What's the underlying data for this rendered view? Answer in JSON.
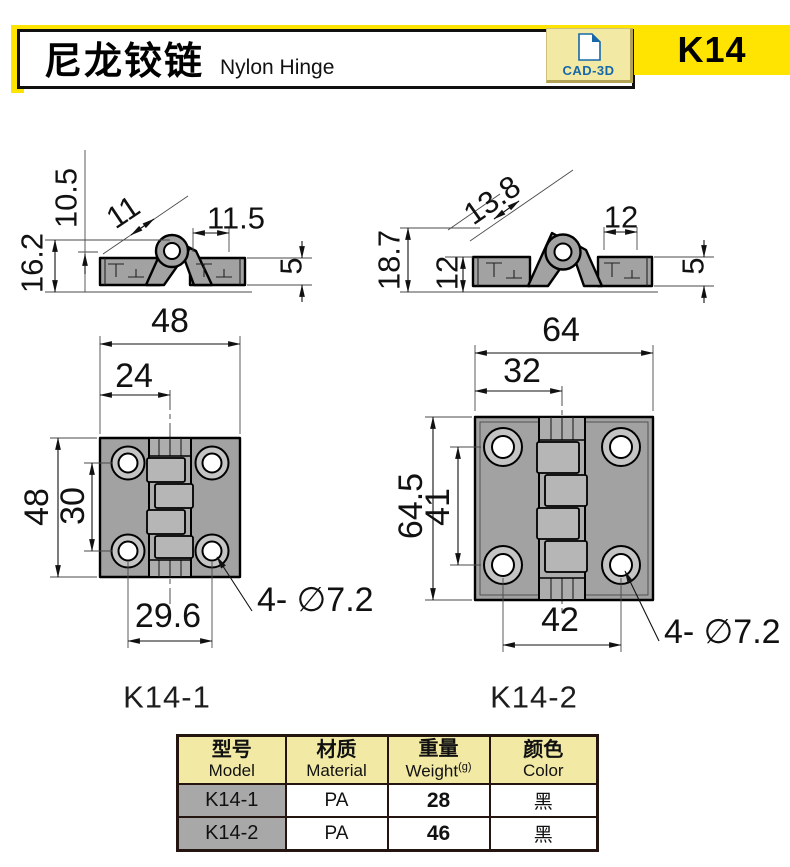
{
  "header": {
    "title_zh": "尼龙铰链",
    "title_en": "Nylon Hinge",
    "cad_badge": "CAD-3D",
    "product_code": "K14"
  },
  "colors": {
    "accent_yellow": "#FFE402",
    "pale_yellow": "#F2EAA4",
    "badge_blue": "#1668A8",
    "part_gray": "#A2A2A2",
    "table_border": "#241510"
  },
  "drawings": {
    "side_small": {
      "dim_height_outer": "16.2",
      "dim_height_inner": "10.5",
      "dim_knuckle": "11",
      "dim_leaf": "11.5",
      "dim_thickness": "5"
    },
    "side_large": {
      "dim_height_outer": "18.7",
      "dim_height_inner": "12",
      "dim_knuckle": "13.8",
      "dim_leaf": "12",
      "dim_thickness": "5"
    },
    "front_small": {
      "label": "K14-1",
      "dim_width": "48",
      "dim_half_width": "24",
      "dim_height": "48",
      "dim_hole_spacing_v": "30",
      "dim_hole_spacing_h": "29.6",
      "dim_holes": "4- ∅7.2"
    },
    "front_large": {
      "label": "K14-2",
      "dim_width": "64",
      "dim_half_width": "32",
      "dim_height": "64.5",
      "dim_hole_spacing_v": "41",
      "dim_hole_spacing_h": "42",
      "dim_holes": "4- ∅7.2"
    }
  },
  "spec_table": {
    "headers": [
      {
        "zh": "型号",
        "en": "Model"
      },
      {
        "zh": "材质",
        "en": "Material"
      },
      {
        "zh": "重量",
        "en": "Weight",
        "unit": "(g)"
      },
      {
        "zh": "颜色",
        "en": "Color"
      }
    ],
    "rows": [
      {
        "model": "K14-1",
        "material": "PA",
        "weight": "28",
        "color": "黑"
      },
      {
        "model": "K14-2",
        "material": "PA",
        "weight": "46",
        "color": "黑"
      }
    ]
  }
}
